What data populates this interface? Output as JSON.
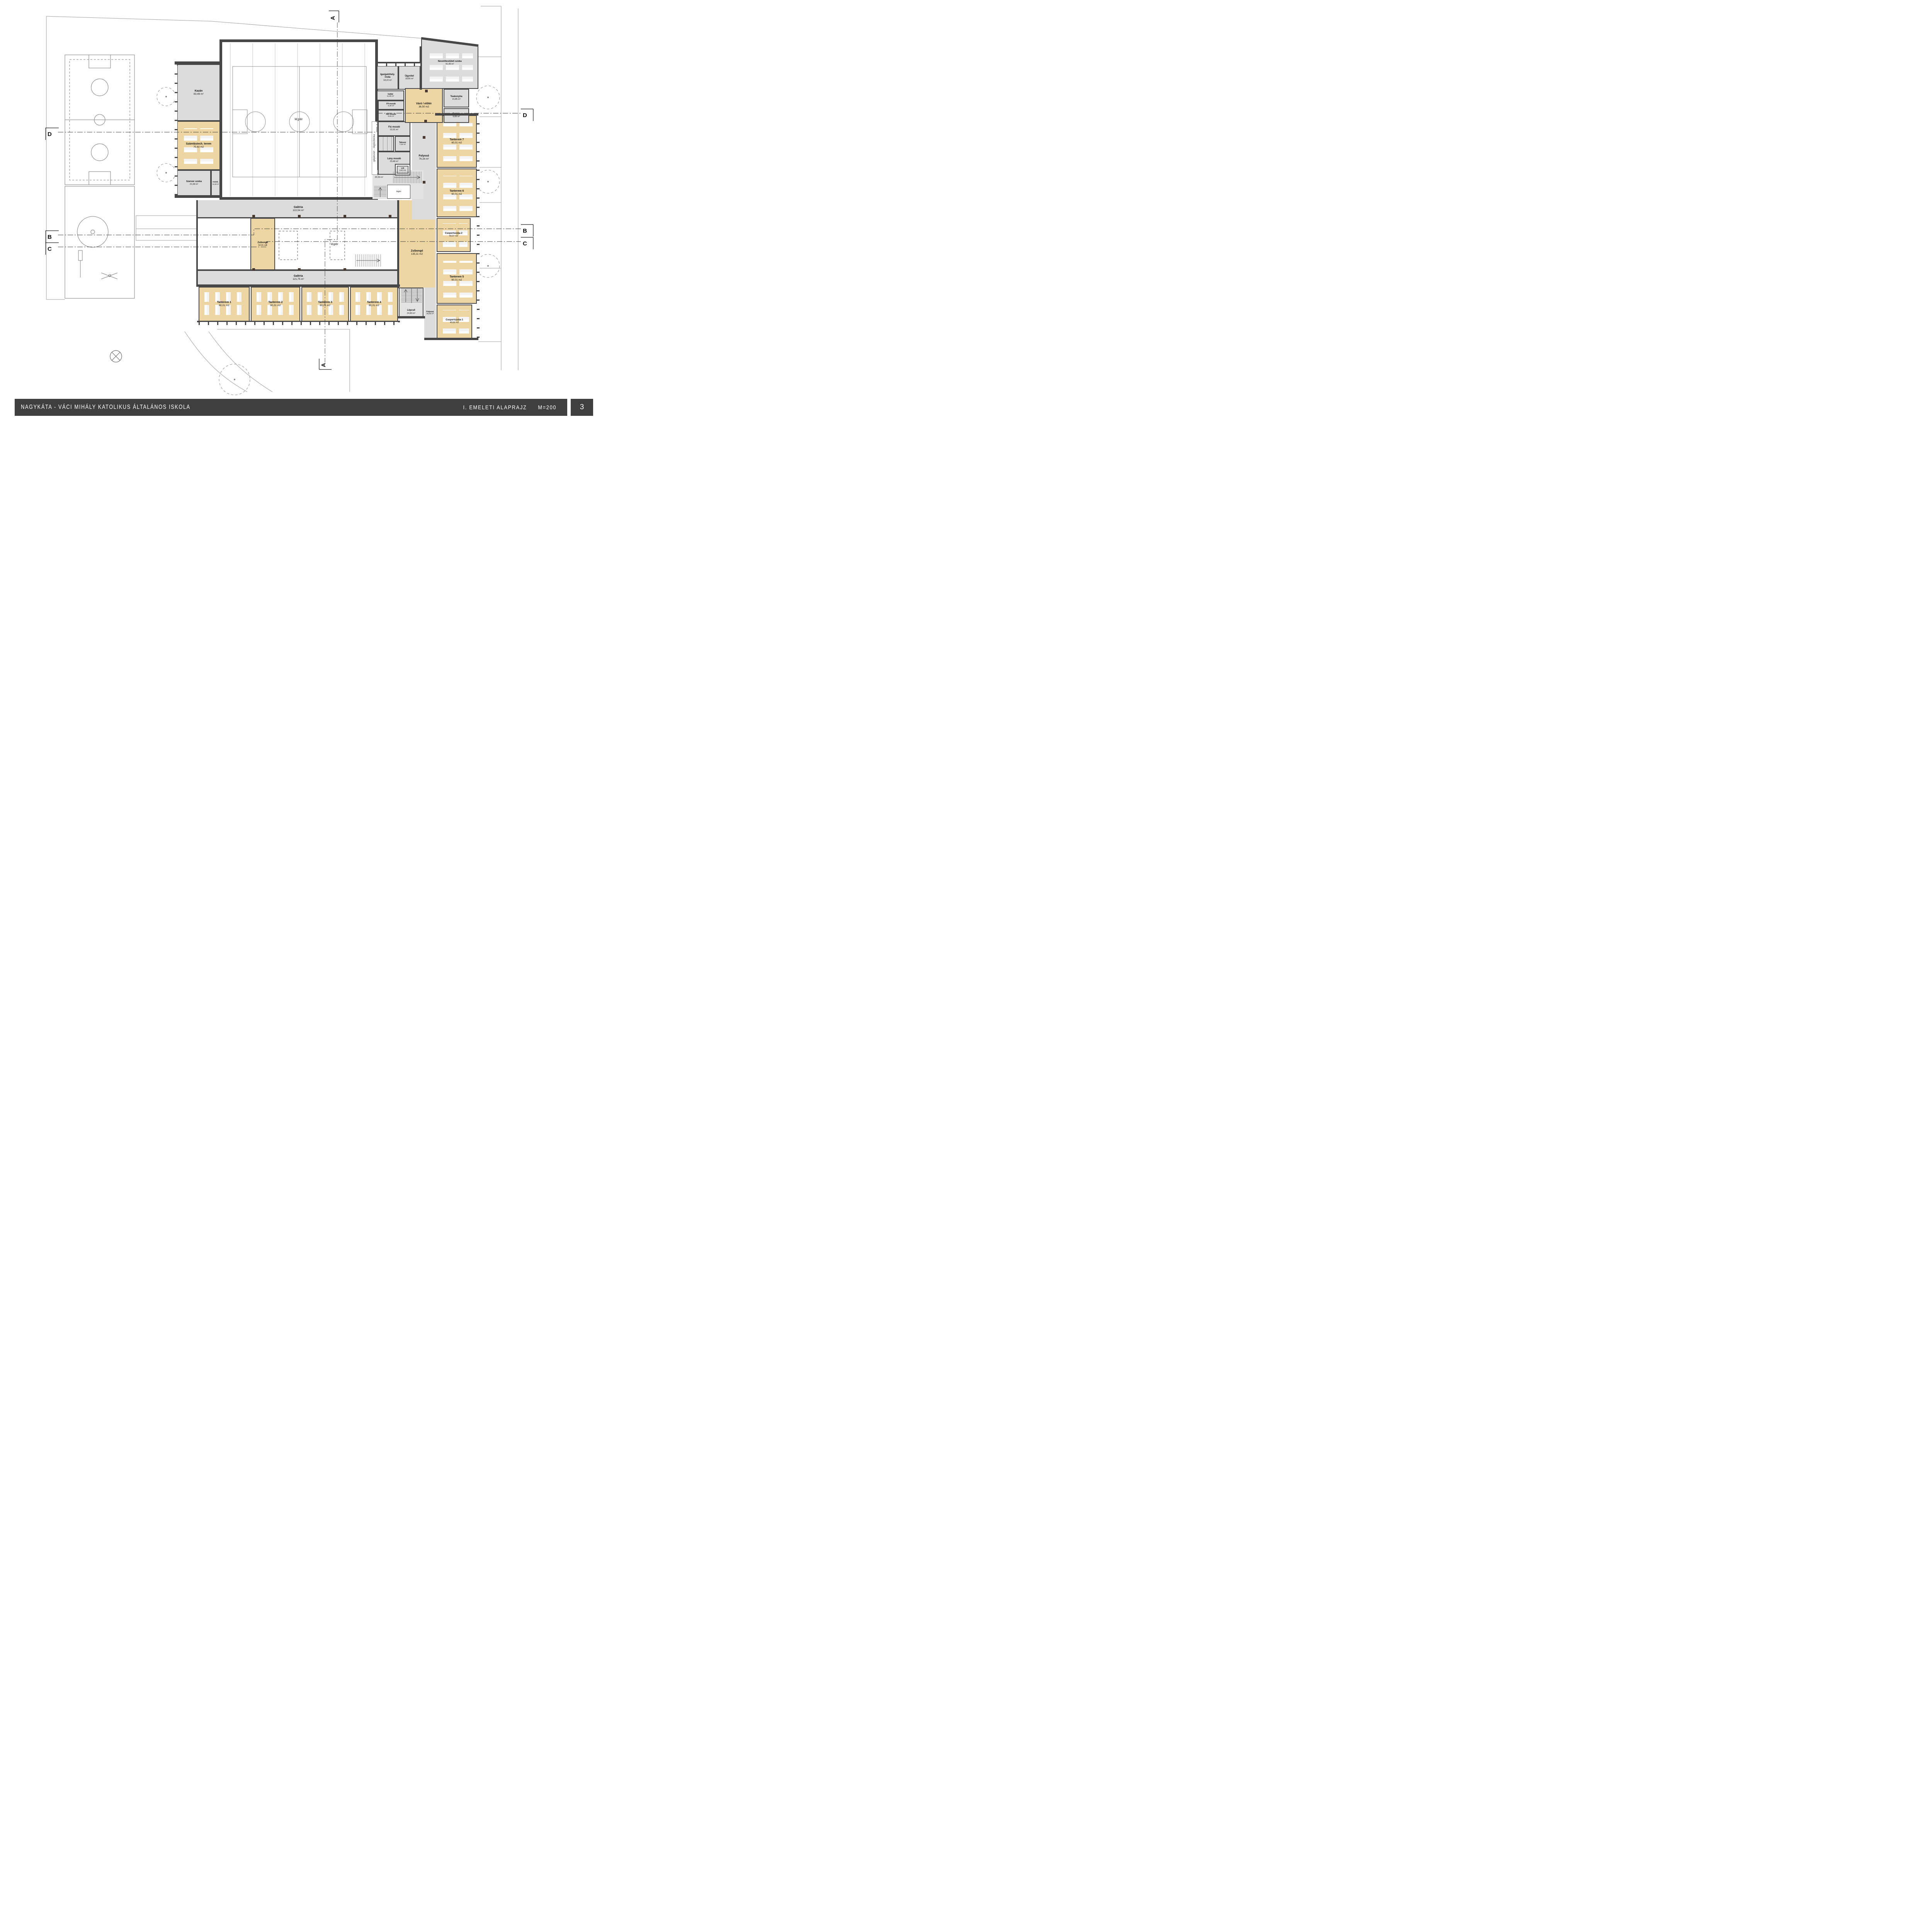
{
  "title_block": {
    "project": "NAGYKÁTA - VÁCI MIHÁLY KATOLIKUS ÁLTALÁNOS ISKOLA",
    "drawing_title": "I. EMELETI ALAPRAJZ",
    "scale": "M=200",
    "page_number": "3"
  },
  "markers": {
    "a_top": "A",
    "a_bottom": "A",
    "b_left": "B",
    "b_right": "B",
    "c_left": "C",
    "c_right": "C",
    "d_left": "D",
    "d_right": "D"
  },
  "rooms": {
    "kazan": {
      "name": "Kazán",
      "area": "83,49 m²"
    },
    "szamtastech": {
      "name": "Számtástech. terem",
      "area": "75,60 m2"
    },
    "szerver": {
      "name": "Szerver szoba",
      "area": "21,68 m²"
    },
    "kozlek": {
      "name": "Közlek.",
      "area": "12,26 m²"
    },
    "legter_gym": {
      "name": "légtér"
    },
    "galeria_felso": {
      "name": "Galéria",
      "area": "122,54 m²"
    },
    "zsibongo_kis": {
      "name": "Zsibongó",
      "area": "52,91 m2"
    },
    "legter_kozep": {
      "name": "légtér"
    },
    "galeria_also": {
      "name": "Galéria",
      "area": "121,75 m²"
    },
    "tanterem1": {
      "name": "Tanterem 1",
      "area": "60,01 m2"
    },
    "tanterem2": {
      "name": "Tanterem 2",
      "area": "60,01 m2"
    },
    "tanterem3": {
      "name": "Tanterem 3",
      "area": "60,01 m2"
    },
    "tanterem4": {
      "name": "Tanterem 4",
      "area": "60,01 m2"
    },
    "lepcso_del": {
      "name": "Lépcső",
      "area": "24,83 m²"
    },
    "folyoso_del": {
      "name": "Folyosó",
      "area": "28,56 m²"
    },
    "zsibongo_nagy": {
      "name": "Zsibongó",
      "area": "135,11 m2"
    },
    "csoportszoba1": {
      "name": "Csoportszoba 1",
      "area": "40,00 m2"
    },
    "tanterem5": {
      "name": "Tanterem 5",
      "area": "60,01 m2"
    },
    "csoportszoba2": {
      "name": "Csoportszoba 2",
      "area": "40,37 m2"
    },
    "tanterem6": {
      "name": "Tanterem 6",
      "area": "60,01 m2"
    },
    "tanterem7": {
      "name": "Tanterem 7",
      "area": "60,01 m2"
    },
    "folyoso_fo": {
      "name": "Folyosó",
      "area": "76,34 m²"
    },
    "lepcso_kozep": {
      "name": "Lépcső",
      "area": "20,59 m²"
    },
    "legter_lepcso": {
      "name": "légtér"
    },
    "lift": {
      "name": "Lift",
      "area": "3,60 m2"
    },
    "lany_mosdo": {
      "name": "Lány mosdó",
      "area": "23,48 m²"
    },
    "takszer": {
      "name": "Takszer",
      "area": "7,02 m²"
    },
    "fiu_mosdo": {
      "name": "Fiú mosdó",
      "area": "22,01 m²"
    },
    "noi_mosdo": {
      "name": "Női mosdó",
      "area": "8,26 m²"
    },
    "ffi_mosdo": {
      "name": "Ffi mosdó",
      "area": "6,39 m²"
    },
    "irattar": {
      "name": "Irattár",
      "area": "11,85 m²"
    },
    "igazgato": {
      "name": "Igazgatóhely. iroda",
      "area": "18,22 m²"
    },
    "ugyvitel": {
      "name": "Ügyvitel",
      "area": "18,66 m²"
    },
    "varo": {
      "name": "Váró / előtér",
      "area": "38,50 m2"
    },
    "nevelotestuleti": {
      "name": "Nevelőtestületi szoba",
      "area": "91,95 m²"
    },
    "teakonyha": {
      "name": "Teakonyha",
      "area": "15,85 m²"
    },
    "raktar": {
      "name": "Raktár",
      "area": "9,89 m²"
    },
    "gepeszet": {
      "name": "gépészet - légtechnika"
    }
  },
  "colors": {
    "wall": "#474747",
    "room_gray": "#dcdcdc",
    "room_tan": "#eed6a4",
    "titlebar": "#3f3f3f",
    "line_light": "#9a9a9a"
  }
}
